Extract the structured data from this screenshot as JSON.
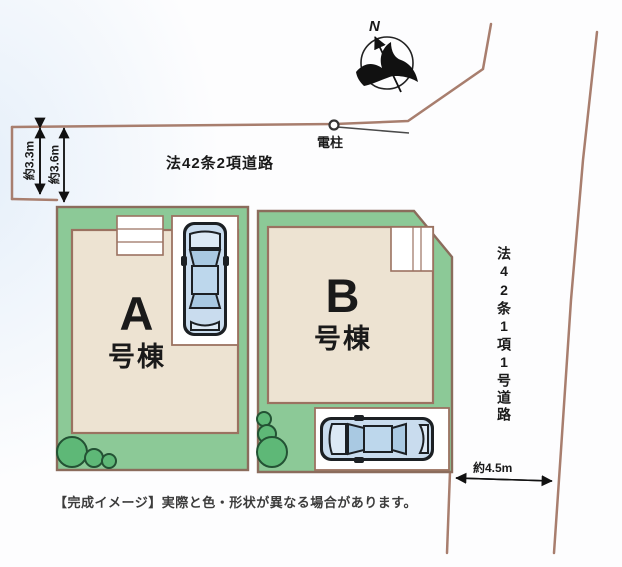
{
  "title": "分譲地区画図（完成イメージ）",
  "compass": {
    "north_label": "N"
  },
  "labels": {
    "utility_pole": "電柱",
    "top_road": "法42条2項道路",
    "right_road": "法42条1項1号道路",
    "disclaimer": "【完成イメージ】実際と色・形状が異なる場合があります。"
  },
  "measurements": {
    "left_outer": "約3.3m",
    "left_inner": "約3.6m",
    "bottom_right": "約4.5m"
  },
  "lots": [
    {
      "id": "A",
      "building_label": "A",
      "building_suffix": "号棟"
    },
    {
      "id": "B",
      "building_label": "B",
      "building_suffix": "号棟"
    }
  ],
  "colors": {
    "lot_green": "#8cc997",
    "building_beige": "#ede3d2",
    "outline_brown": "#8b6c5c",
    "road_line": "#a87e6e",
    "bush_green": "#5eb877",
    "bush_outline": "#235234",
    "car_body_blue": "#c9dcee",
    "car_outline": "#1c2024",
    "pad_white": "#ffffff"
  }
}
